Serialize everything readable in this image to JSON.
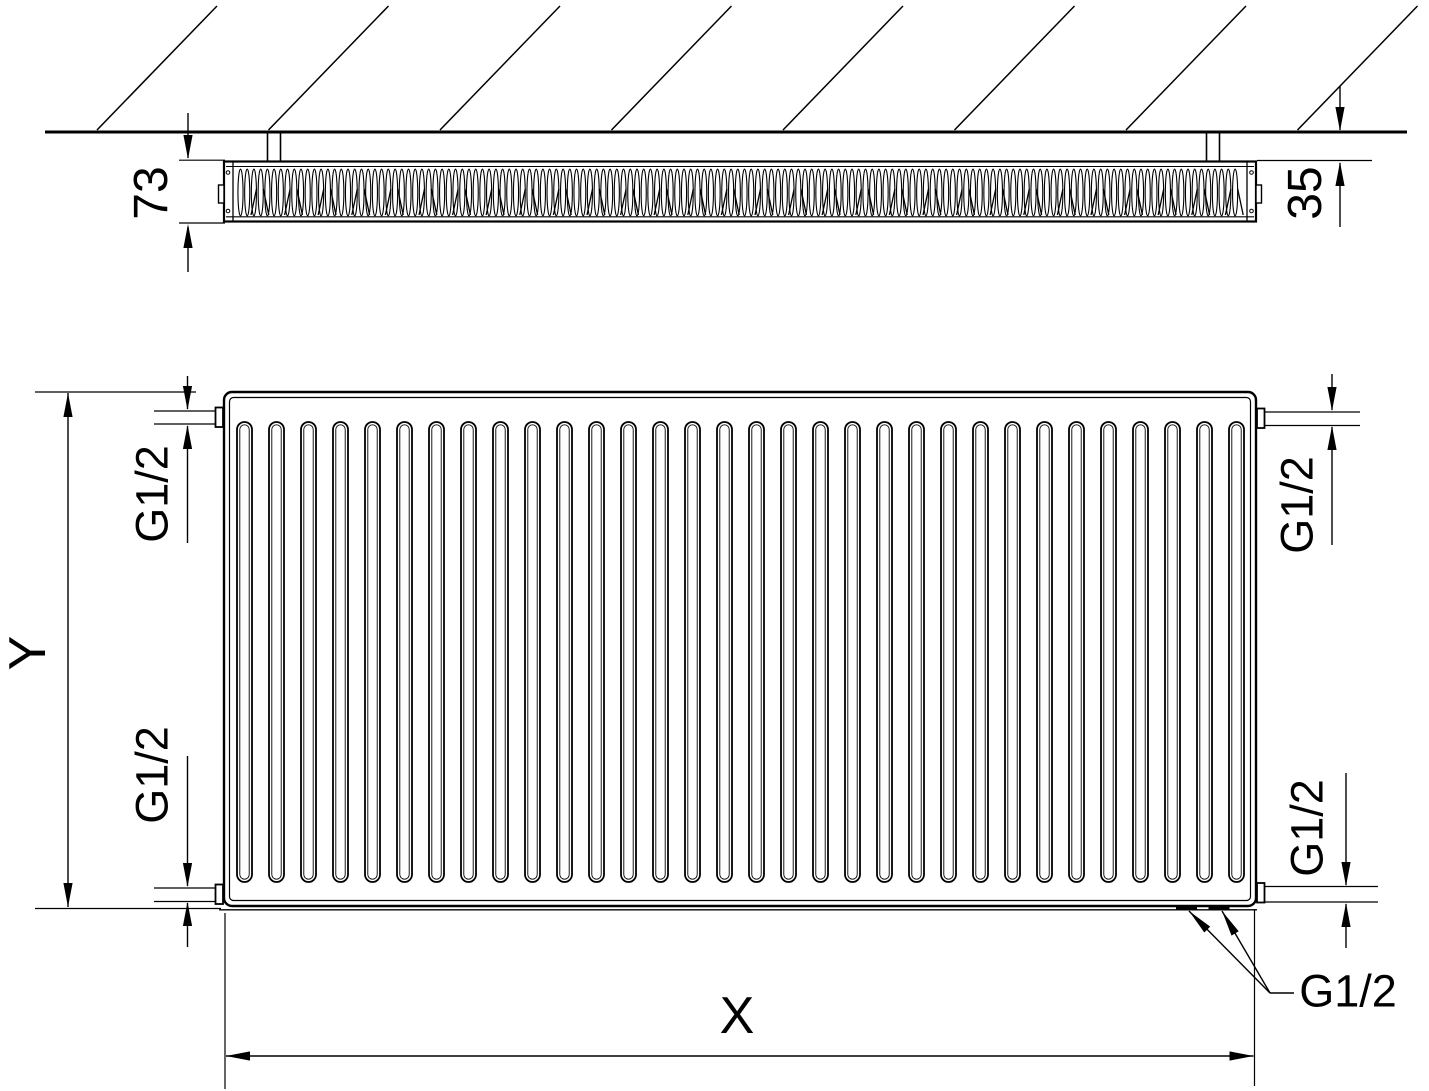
{
  "page": {
    "background": "#ffffff",
    "line_color": "#000000",
    "description": "Technical dimensional drawing of a panel radiator: top view against hatched wall and front view with connection dimensions"
  },
  "labels": {
    "depth": "73",
    "wall_distance": "35",
    "height": "Y",
    "width": "X",
    "conn_top_left": "G1/2",
    "conn_bottom_left": "G1/2",
    "conn_top_right": "G1/2",
    "conn_bottom_right": "G1/2",
    "conn_bottom": "G1/2"
  }
}
